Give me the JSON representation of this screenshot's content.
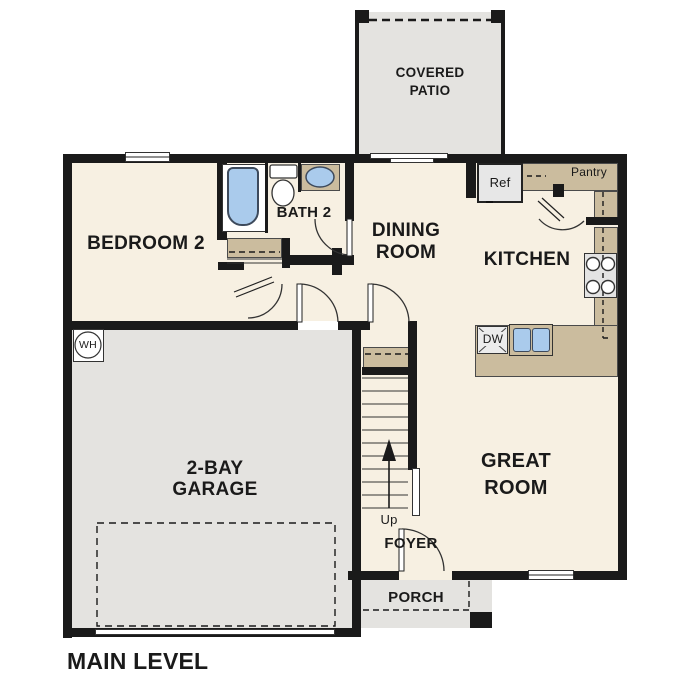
{
  "title": "MAIN LEVEL",
  "rooms": {
    "covered_patio": "COVERED\nPATIO",
    "bedroom2": "BEDROOM 2",
    "bath2": "BATH 2",
    "dining": "DINING\nROOM",
    "kitchen": "KITCHEN",
    "garage": "2-BAY\nGARAGE",
    "great_room": "GREAT\nROOM",
    "foyer": "FOYER",
    "porch": "PORCH"
  },
  "fixtures": {
    "refrigerator": "Ref",
    "pantry": "Pantry",
    "dishwasher": "DW",
    "water_heater": "WH",
    "stairs_up": "Up"
  },
  "colors": {
    "floor": "#f7f0e2",
    "slab": "#e4e3e0",
    "counter": "#cbbc9e",
    "fixture_blue": "#aacbec",
    "wall": "#1a1a1a"
  }
}
